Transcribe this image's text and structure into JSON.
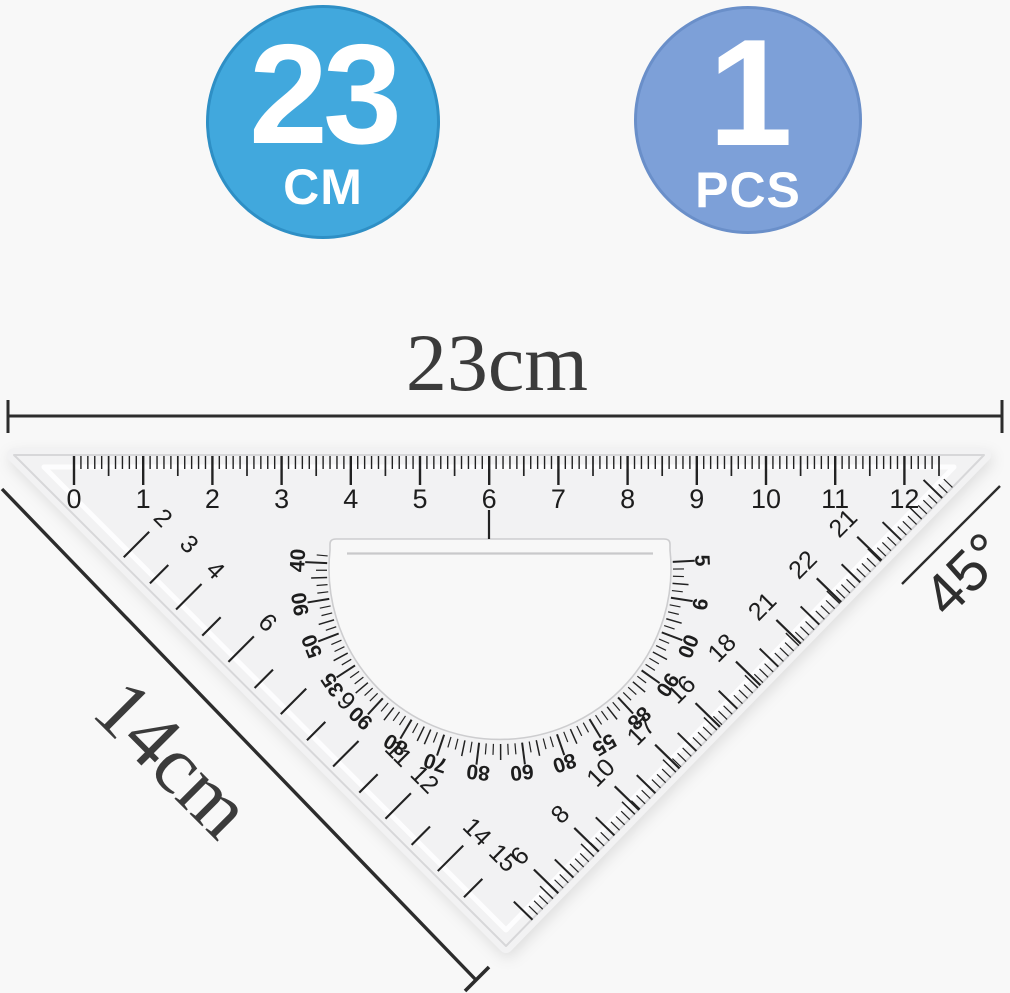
{
  "scene": {
    "background": "#f8f8f8",
    "description": "45-degree triangle set square ruler with protractor cutout, dimension annotations"
  },
  "badges": [
    {
      "value": "23",
      "unit": "CM",
      "bg_color": "#41a8dd",
      "border_color": "#2e8fc5"
    },
    {
      "value": "1",
      "unit": "PCS",
      "bg_color": "#7da0d8",
      "border_color": "#6a8fc9"
    }
  ],
  "dimension_labels": {
    "top": "23cm",
    "left": "14cm",
    "angle": "45°"
  },
  "ruler": {
    "body_color": "#f2f2f3",
    "edge_color": "#d7d7d9",
    "tick_color": "#222222",
    "top_scale": {
      "unit_labels": [
        "0",
        "1",
        "2",
        "3",
        "4",
        "5",
        "6",
        "7",
        "8",
        "9",
        "10",
        "11",
        "12"
      ]
    },
    "left_scale": {
      "labels": [
        "2",
        "3",
        "4",
        "6",
        "9",
        "11",
        "12",
        "14",
        "15"
      ]
    },
    "right_scale": {
      "labels": [
        "6",
        "8",
        "10",
        "17",
        "16",
        "18",
        "21",
        "22",
        "21"
      ]
    },
    "protractor": {
      "labels": [
        "40",
        "90",
        "50",
        "35",
        "90",
        "80",
        "70",
        "80",
        "60",
        "80",
        "55",
        "88",
        "90",
        "00",
        "9",
        "5"
      ]
    }
  }
}
